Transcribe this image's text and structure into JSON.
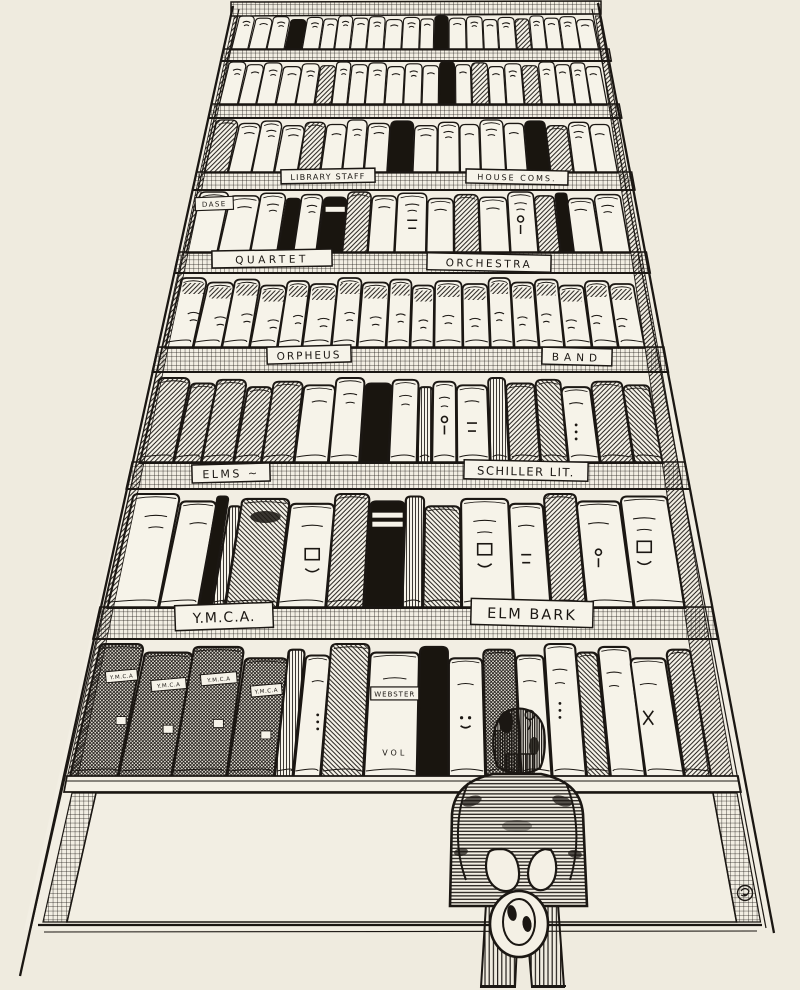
{
  "scene": {
    "description": "Pen-and-ink cartoon: a man seen from behind, hat in hands, gazing up at a towering bookcase of club record books",
    "paper_color": "#efebdf",
    "book_paper_color": "#f6f3e9",
    "ink_color": "#1b1713"
  },
  "shelf_labels": {
    "library_staff": "LIBRARY STAFF",
    "house_coms": "HOUSE COMS.",
    "quartet": "QUARTET",
    "orchestra": "ORCHESTRA",
    "orpheus": "ORPHEUS",
    "band": "BAND",
    "elms": "ELMS ~",
    "schiller_lit": "SCHILLER LIT.",
    "ymca": "Y.M.C.A.",
    "elm_bark": "ELM BARK"
  },
  "spine_labels": {
    "dase": "DASE",
    "webster": "WEBSTER",
    "webster_vol": "VOL",
    "ymca_small": "Y.M.C.A"
  }
}
